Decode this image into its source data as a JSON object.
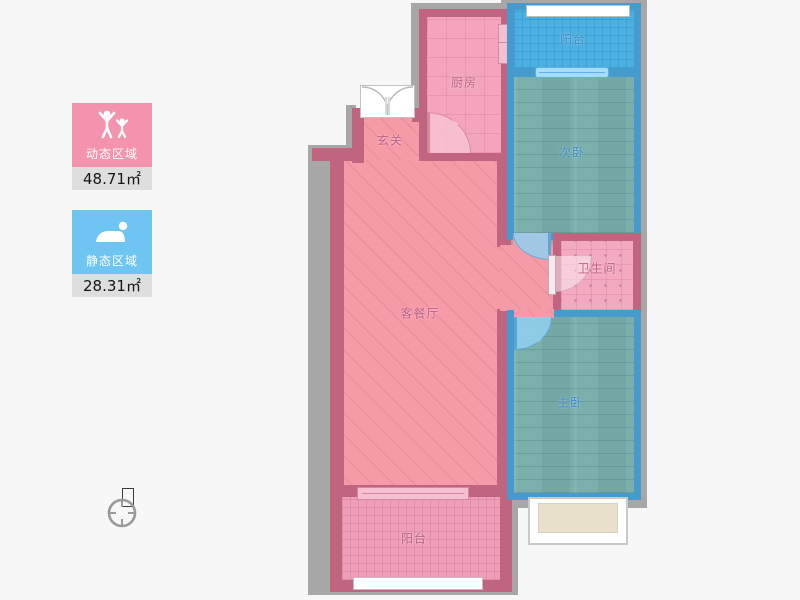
{
  "legend": {
    "items": [
      {
        "id": "dynamic",
        "label": "动态区域",
        "value": "48.71",
        "unit": "㎡",
        "icon": "people-arms-up-icon",
        "color": "#f493ad"
      },
      {
        "id": "static",
        "label": "静态区域",
        "value": "28.31",
        "unit": "㎡",
        "icon": "person-sleeping-icon",
        "color": "#6fc5f2"
      }
    ]
  },
  "compass": {
    "north_label": "北"
  },
  "floorplan": {
    "rooms": [
      {
        "id": "balcony-top",
        "label": "阳台"
      },
      {
        "id": "kitchen",
        "label": "厨房"
      },
      {
        "id": "entry",
        "label": "玄关"
      },
      {
        "id": "bedroom-second",
        "label": "次卧"
      },
      {
        "id": "bathroom",
        "label": "卫生间"
      },
      {
        "id": "living-dining",
        "label": "客餐厅"
      },
      {
        "id": "bedroom-master",
        "label": "主卧"
      },
      {
        "id": "balcony-bottom",
        "label": "阳台"
      }
    ]
  },
  "colors": {
    "dynamic_zone": "#f493ad",
    "static_zone": "#6fc5f2",
    "pink_wall": "#c0647f",
    "blue_wall": "#459bce",
    "outer_wall": "#a7a7a7",
    "living_fill": "#f59ba7",
    "wood_floor": "#7aafab",
    "balcony_top_fill": "#4ab0e2",
    "bay_window_fill": "#e8e0cb"
  }
}
